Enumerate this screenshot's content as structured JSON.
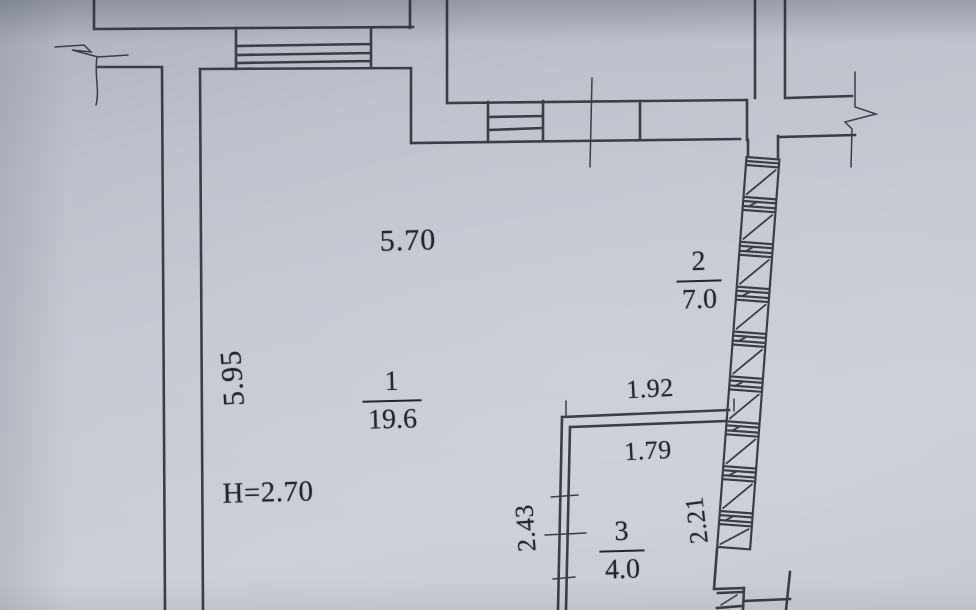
{
  "plan": {
    "type_note": "apartment floor plan (BTI style photo)",
    "rooms": [
      {
        "number": "1",
        "area": "19.6"
      },
      {
        "number": "2",
        "area": "7.0"
      },
      {
        "number": "3",
        "area": "4.0"
      }
    ],
    "dimensions": {
      "room1_width_top": "5.70",
      "room1_height_left": "5.95",
      "ceiling_height_note": "H=2.70",
      "room3_width_outer": "1.92",
      "room3_width_inner": "1.79",
      "room3_height_left": "2.43",
      "room3_height_right": "2.21"
    },
    "colors": {
      "paper": "#c4c9d2",
      "ink": "#23272e",
      "wall_line": "#3a3e45"
    }
  }
}
